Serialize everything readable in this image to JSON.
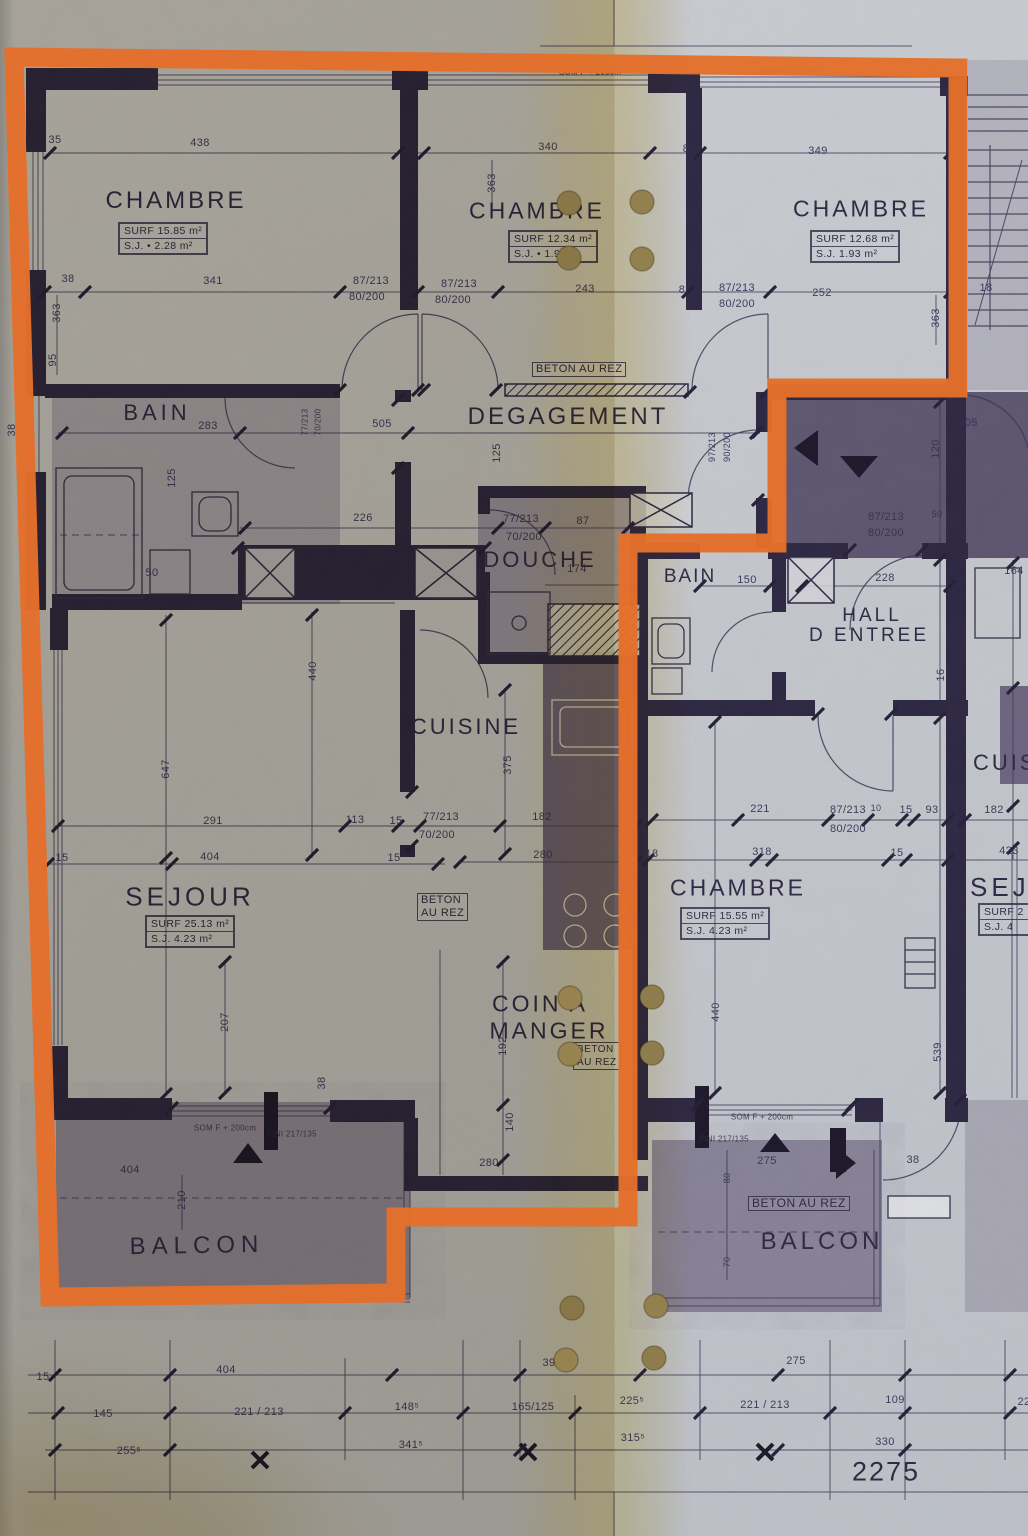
{
  "colors": {
    "highlight_orange": "#e4702b",
    "ink_walls": "#2c2640",
    "ink_thin": "#3b3456",
    "paper": "#c6c9cd",
    "fold_yellow": "#d8c078",
    "punch_hole_tan": "#8d7a4e",
    "shaded_room": "#5b4e74"
  },
  "rooms": {
    "chambre_tl": {
      "name": "CHAMBRE",
      "surf": "SURF 15.85 m²",
      "sj": "S.J. • 2.28 m²"
    },
    "chambre_tm": {
      "name": "CHAMBRE",
      "surf": "SURF 12.34 m²",
      "sj": "S.J. • 1.9 m²"
    },
    "chambre_tr": {
      "name": "CHAMBRE",
      "surf": "SURF 12.68 m²",
      "sj": "S.J. 1.93 m²"
    },
    "bain_left": {
      "name": "BAIN"
    },
    "degagement": {
      "name": "DEGAGEMENT"
    },
    "douche": {
      "name": "DOUCHE"
    },
    "bain_right": {
      "name": "BAIN"
    },
    "hall": {
      "line1": "HALL",
      "line2": "D ENTREE"
    },
    "cuisine": {
      "name": "CUISINE"
    },
    "sejour": {
      "name": "SEJOUR",
      "surf": "SURF 25.13 m²",
      "sj": "S.J. 4.23 m²"
    },
    "coin_a_manger": {
      "line1": "COIN A",
      "line2": "MANGER"
    },
    "chambre_right": {
      "name": "CHAMBRE",
      "surf": "SURF 15.55 m²",
      "sj": "S.J. 4.23 m²"
    },
    "balcon_left": {
      "name": "BALCON"
    },
    "balcon_right": {
      "name": "BALCON"
    },
    "cuisine_neighbor": {
      "name": "CUISINE"
    },
    "sejour_neighbor": {
      "name": "SEJOUR",
      "surf": "SURF 2",
      "sj": "S.J. 4"
    }
  },
  "annotations": {
    "beton_corridor": "BETON AU REZ",
    "beton_sejour_l1": "BETON",
    "beton_sejour_l2": "AU REZ",
    "beton_coin_l1": "BETON",
    "beton_coin_l2": "AU REZ",
    "beton_balcon": "BETON AU REZ",
    "sill_top_mid": "SOM F + 200cm",
    "sill_top_right": "SOM F + 220cm",
    "sill_left_wall": "SOM F + 200cm",
    "sill_balcon_left": "SOM F + 200cm",
    "fin_balcon_left": "FINI 217/135",
    "sill_balcon_right": "SOM F + 200cm",
    "fin_balcon_right": "FINI 217/135",
    "total_width": "2275"
  },
  "dim_labels": [
    {
      "t": "438",
      "x": 200,
      "y": 143
    },
    {
      "t": "8",
      "x": 409,
      "y": 145
    },
    {
      "t": "340",
      "x": 548,
      "y": 147
    },
    {
      "t": "8",
      "x": 686,
      "y": 149
    },
    {
      "t": "349",
      "x": 818,
      "y": 151
    },
    {
      "t": "35",
      "x": 55,
      "y": 140
    },
    {
      "t": "38",
      "x": 68,
      "y": 279
    },
    {
      "t": "341",
      "x": 213,
      "y": 281
    },
    {
      "t": "87/213",
      "x": 371,
      "y": 281
    },
    {
      "t": "80/200",
      "x": 367,
      "y": 297
    },
    {
      "t": "87/213",
      "x": 459,
      "y": 284
    },
    {
      "t": "80/200",
      "x": 453,
      "y": 300
    },
    {
      "t": "243",
      "x": 585,
      "y": 289
    },
    {
      "t": "8",
      "x": 682,
      "y": 290
    },
    {
      "t": "87/213",
      "x": 737,
      "y": 288
    },
    {
      "t": "80/200",
      "x": 737,
      "y": 304
    },
    {
      "t": "252",
      "x": 822,
      "y": 293
    },
    {
      "t": "18",
      "x": 986,
      "y": 288
    },
    {
      "t": "363",
      "x": 57,
      "y": 313,
      "r": -90
    },
    {
      "t": "95",
      "x": 53,
      "y": 360,
      "r": -90
    },
    {
      "t": "363",
      "x": 492,
      "y": 183,
      "r": -90
    },
    {
      "t": "363",
      "x": 936,
      "y": 318,
      "r": -90
    },
    {
      "t": "38",
      "x": 12,
      "y": 430,
      "r": -90
    },
    {
      "t": "283",
      "x": 208,
      "y": 426
    },
    {
      "t": "505",
      "x": 382,
      "y": 424
    },
    {
      "t": "125",
      "x": 497,
      "y": 453,
      "r": -90
    },
    {
      "t": "125",
      "x": 172,
      "y": 478,
      "r": -90
    },
    {
      "t": "97/213",
      "x": 712,
      "y": 447,
      "r": -90,
      "s": 9
    },
    {
      "t": "90/200",
      "x": 727,
      "y": 447,
      "r": -90,
      "s": 9
    },
    {
      "t": "77/213",
      "x": 305,
      "y": 422,
      "r": -90,
      "s": 8
    },
    {
      "t": "70/200",
      "x": 318,
      "y": 422,
      "r": -90,
      "s": 8
    },
    {
      "t": "226",
      "x": 363,
      "y": 518
    },
    {
      "t": "77/213",
      "x": 521,
      "y": 519
    },
    {
      "t": "70/200",
      "x": 524,
      "y": 537
    },
    {
      "t": "87",
      "x": 583,
      "y": 521
    },
    {
      "t": "174",
      "x": 577,
      "y": 569
    },
    {
      "t": "150",
      "x": 747,
      "y": 580
    },
    {
      "t": "228",
      "x": 885,
      "y": 578
    },
    {
      "t": "164",
      "x": 1014,
      "y": 571
    },
    {
      "t": "50",
      "x": 937,
      "y": 514,
      "s": 9
    },
    {
      "t": "87/213",
      "x": 886,
      "y": 517
    },
    {
      "t": "80/200",
      "x": 886,
      "y": 533
    },
    {
      "t": "405",
      "x": 968,
      "y": 423
    },
    {
      "t": "120",
      "x": 936,
      "y": 449,
      "r": -90
    },
    {
      "t": "16",
      "x": 941,
      "y": 675,
      "r": -90
    },
    {
      "t": "50",
      "x": 152,
      "y": 573
    },
    {
      "t": "291",
      "x": 213,
      "y": 821
    },
    {
      "t": "113",
      "x": 355,
      "y": 820
    },
    {
      "t": "15",
      "x": 396,
      "y": 821
    },
    {
      "t": "77/213",
      "x": 441,
      "y": 817
    },
    {
      "t": "70/200",
      "x": 437,
      "y": 835
    },
    {
      "t": "182",
      "x": 542,
      "y": 817
    },
    {
      "t": "280",
      "x": 543,
      "y": 855
    },
    {
      "t": "375",
      "x": 508,
      "y": 765,
      "r": -90
    },
    {
      "t": "440",
      "x": 313,
      "y": 671,
      "r": -90
    },
    {
      "t": "647",
      "x": 166,
      "y": 769,
      "r": -90
    },
    {
      "t": "15",
      "x": 62,
      "y": 858
    },
    {
      "t": "404",
      "x": 210,
      "y": 857
    },
    {
      "t": "15",
      "x": 394,
      "y": 858
    },
    {
      "t": "221",
      "x": 760,
      "y": 809
    },
    {
      "t": "87/213",
      "x": 848,
      "y": 810
    },
    {
      "t": "80/200",
      "x": 848,
      "y": 829
    },
    {
      "t": "10",
      "x": 876,
      "y": 808,
      "s": 9
    },
    {
      "t": "15",
      "x": 906,
      "y": 810
    },
    {
      "t": "93",
      "x": 932,
      "y": 810
    },
    {
      "t": "182",
      "x": 994,
      "y": 810
    },
    {
      "t": "18",
      "x": 652,
      "y": 854
    },
    {
      "t": "318",
      "x": 762,
      "y": 852
    },
    {
      "t": "15",
      "x": 897,
      "y": 853
    },
    {
      "t": "423",
      "x": 1009,
      "y": 851
    },
    {
      "t": "440",
      "x": 716,
      "y": 1012,
      "r": -90
    },
    {
      "t": "539",
      "x": 938,
      "y": 1052,
      "r": -90
    },
    {
      "t": "207",
      "x": 225,
      "y": 1022,
      "r": -90
    },
    {
      "t": "38",
      "x": 322,
      "y": 1083,
      "r": -90
    },
    {
      "t": "192",
      "x": 503,
      "y": 1046,
      "r": -90
    },
    {
      "t": "140",
      "x": 510,
      "y": 1122,
      "r": -90
    },
    {
      "t": "280",
      "x": 489,
      "y": 1163
    },
    {
      "t": "404",
      "x": 130,
      "y": 1170
    },
    {
      "t": "210",
      "x": 182,
      "y": 1200,
      "r": -90
    },
    {
      "t": "275",
      "x": 767,
      "y": 1161
    },
    {
      "t": "38",
      "x": 913,
      "y": 1160
    },
    {
      "t": "80",
      "x": 727,
      "y": 1178,
      "r": -90,
      "s": 9
    },
    {
      "t": "70",
      "x": 727,
      "y": 1262,
      "r": -90,
      "s": 9
    },
    {
      "t": "15",
      "x": 43,
      "y": 1377
    },
    {
      "t": "404",
      "x": 226,
      "y": 1370
    },
    {
      "t": "39",
      "x": 549,
      "y": 1363
    },
    {
      "t": "275",
      "x": 796,
      "y": 1361
    },
    {
      "t": "145",
      "x": 103,
      "y": 1414
    },
    {
      "t": "221 / 213",
      "x": 259,
      "y": 1412
    },
    {
      "t": "148⁵",
      "x": 407,
      "y": 1407
    },
    {
      "t": "165/125",
      "x": 533,
      "y": 1407
    },
    {
      "t": "225⁵",
      "x": 632,
      "y": 1401
    },
    {
      "t": "221 / 213",
      "x": 765,
      "y": 1405
    },
    {
      "t": "109",
      "x": 895,
      "y": 1400
    },
    {
      "t": "22",
      "x": 1024,
      "y": 1402
    },
    {
      "t": "255⁵",
      "x": 129,
      "y": 1451
    },
    {
      "t": "341⁵",
      "x": 411,
      "y": 1445
    },
    {
      "t": "315⁵",
      "x": 633,
      "y": 1438
    },
    {
      "t": "330",
      "x": 885,
      "y": 1442
    }
  ]
}
